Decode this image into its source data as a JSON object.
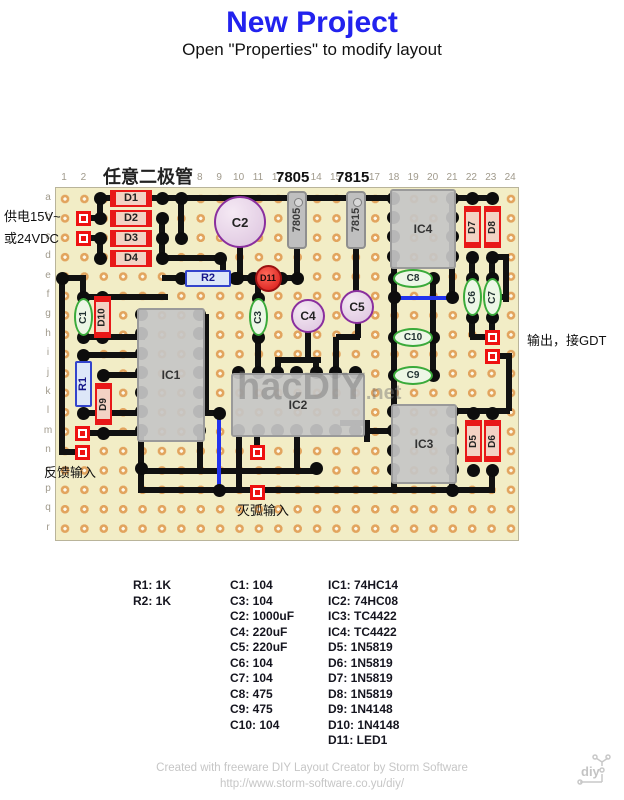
{
  "title": "New Project",
  "subtitle": "Open \"Properties\" to modify layout",
  "annotations": {
    "top_note": "任意二极管",
    "supply_line1": "供电15V~",
    "supply_line2": "或24VDC",
    "output_note": "输出，接GDT",
    "feedback_note": "反馈输入",
    "arc_note": "灭弧输入",
    "reg_header1": "7805",
    "reg_header2": "7815",
    "watermark": "hacDIY",
    "watermark_suffix": ".net"
  },
  "board": {
    "columns": [
      "1",
      "2",
      "3",
      "4",
      "5",
      "6",
      "7",
      "8",
      "9",
      "10",
      "11",
      "12",
      "13",
      "14",
      "15",
      "16",
      "17",
      "18",
      "19",
      "20",
      "21",
      "22",
      "23",
      "24"
    ],
    "rows": [
      "a",
      "b",
      "c",
      "d",
      "e",
      "f",
      "g",
      "h",
      "i",
      "j",
      "k",
      "l",
      "m",
      "n",
      "o",
      "p",
      "q",
      "r"
    ]
  },
  "components": [
    {
      "label": "D1",
      "kind": "diode_h"
    },
    {
      "label": "D2",
      "kind": "diode_h"
    },
    {
      "label": "D3",
      "kind": "diode_h"
    },
    {
      "label": "D4",
      "kind": "diode_h"
    },
    {
      "label": "7805",
      "kind": "regulator"
    },
    {
      "label": "7815",
      "kind": "regulator"
    },
    {
      "label": "C2",
      "kind": "ecap"
    },
    {
      "label": "IC4",
      "kind": "ic"
    },
    {
      "label": "D7",
      "kind": "diode_v"
    },
    {
      "label": "D8",
      "kind": "diode_v"
    },
    {
      "label": "R2",
      "kind": "resistor_h"
    },
    {
      "label": "D11",
      "kind": "led"
    },
    {
      "label": "C1",
      "kind": "cap_v"
    },
    {
      "label": "D10",
      "kind": "diode_v"
    },
    {
      "label": "C3",
      "kind": "cap_v"
    },
    {
      "label": "C4",
      "kind": "ecap"
    },
    {
      "label": "C5",
      "kind": "ecap"
    },
    {
      "label": "C8",
      "kind": "cap_h"
    },
    {
      "label": "C6",
      "kind": "cap_v"
    },
    {
      "label": "C7",
      "kind": "cap_v"
    },
    {
      "label": "C10",
      "kind": "cap_h"
    },
    {
      "label": "C9",
      "kind": "cap_h"
    },
    {
      "label": "IC1",
      "kind": "ic"
    },
    {
      "label": "R1",
      "kind": "resistor_v"
    },
    {
      "label": "D9",
      "kind": "diode_v"
    },
    {
      "label": "IC2",
      "kind": "ic"
    },
    {
      "label": "IC3",
      "kind": "ic"
    },
    {
      "label": "D5",
      "kind": "diode_v"
    },
    {
      "label": "D6",
      "kind": "diode_v"
    }
  ],
  "parts_list": {
    "col1": [
      "R1: 1K",
      "R2: 1K"
    ],
    "col2": [
      "C1: 104",
      "C3: 104",
      "C2: 1000uF",
      "C4: 220uF",
      "C5: 220uF",
      "C6: 104",
      "C7: 104",
      "C8: 475",
      "C9: 475",
      "C10: 104"
    ],
    "col3": [
      "IC1: 74HC14",
      "IC2: 74HC08",
      "IC3: TC4422",
      "IC4: TC4422",
      "D5: 1N5819",
      "D6: 1N5819",
      "D7: 1N5819",
      "D8: 1N5819",
      "D9: 1N4148",
      "D10: 1N4148",
      "D11: LED1"
    ]
  },
  "footer": {
    "line1": "Created with freeware DIY Layout Creator by Storm Software",
    "line2": "http://www.storm-software.co.yu/diy/",
    "logo_text": "diy"
  },
  "colors": {
    "title_blue": "#2222ee",
    "board_tan": "#f2edc6",
    "wire_black": "#111111",
    "jumper_blue": "#2233ee",
    "pad_red": "#ee1111",
    "diode_red": "#e81818",
    "resistor_blue": "#3344cc",
    "cap_green": "#3aaa3a",
    "cap_purple": "#8a2f9e"
  }
}
